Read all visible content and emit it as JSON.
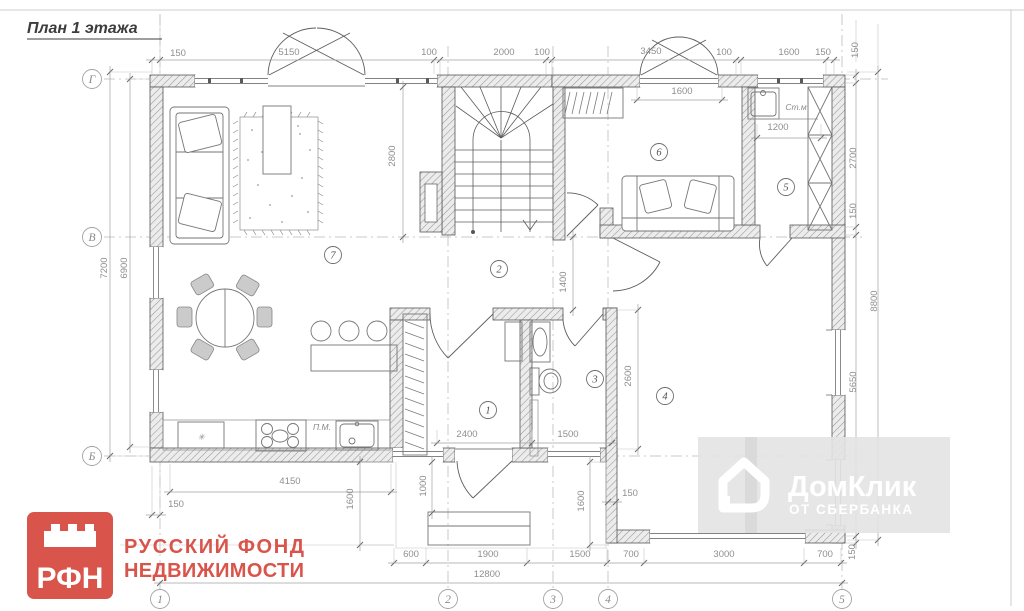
{
  "title": "План 1 этажа",
  "colors": {
    "accent_red": "#d9544b",
    "watermark_gray": "#e3e3e3",
    "drawing_line": "#565656",
    "dimension_gray": "#8f8f8f"
  },
  "plan": {
    "dimensions": [
      {
        "t": "150",
        "x": 178,
        "y": 56,
        "r": 0
      },
      {
        "t": "5150",
        "x": 289,
        "y": 55,
        "r": 0
      },
      {
        "t": "100",
        "x": 429,
        "y": 55,
        "r": 0
      },
      {
        "t": "2000",
        "x": 504,
        "y": 55,
        "r": 0
      },
      {
        "t": "100",
        "x": 542,
        "y": 55,
        "r": 0
      },
      {
        "t": "3450",
        "x": 651,
        "y": 54,
        "r": 0
      },
      {
        "t": "100",
        "x": 724,
        "y": 55,
        "r": 0
      },
      {
        "t": "1600",
        "x": 789,
        "y": 55,
        "r": 0
      },
      {
        "t": "150",
        "x": 823,
        "y": 55,
        "r": 0
      },
      {
        "t": "150",
        "x": 858,
        "y": 50,
        "r": -90
      },
      {
        "t": "2700",
        "x": 856,
        "y": 158,
        "r": -90
      },
      {
        "t": "150",
        "x": 856,
        "y": 211,
        "r": -90
      },
      {
        "t": "5650",
        "x": 856,
        "y": 382,
        "r": -90
      },
      {
        "t": "8800",
        "x": 877,
        "y": 301,
        "r": -90
      },
      {
        "t": "7200",
        "x": 107,
        "y": 268,
        "r": -90
      },
      {
        "t": "6900",
        "x": 127,
        "y": 268,
        "r": -90
      },
      {
        "t": "2800",
        "x": 395,
        "y": 156,
        "r": -90
      },
      {
        "t": "1400",
        "x": 566,
        "y": 282,
        "r": -90
      },
      {
        "t": "1600",
        "x": 682,
        "y": 94,
        "r": 0
      },
      {
        "t": "1200",
        "x": 778,
        "y": 130,
        "r": 0
      },
      {
        "t": "2400",
        "x": 467,
        "y": 437,
        "r": 0
      },
      {
        "t": "1500",
        "x": 568,
        "y": 437,
        "r": 0
      },
      {
        "t": "2600",
        "x": 631,
        "y": 376,
        "r": -90
      },
      {
        "t": "150",
        "x": 176,
        "y": 507,
        "r": 0
      },
      {
        "t": "4150",
        "x": 290,
        "y": 484,
        "r": 0
      },
      {
        "t": "1600",
        "x": 353,
        "y": 499,
        "r": -90
      },
      {
        "t": "1000",
        "x": 426,
        "y": 486,
        "r": -90
      },
      {
        "t": "1600",
        "x": 584,
        "y": 501,
        "r": -90
      },
      {
        "t": "150",
        "x": 630,
        "y": 496,
        "r": 0
      },
      {
        "t": "600",
        "x": 411,
        "y": 557,
        "r": 0
      },
      {
        "t": "1900",
        "x": 488,
        "y": 557,
        "r": 0
      },
      {
        "t": "1500",
        "x": 580,
        "y": 557,
        "r": 0
      },
      {
        "t": "700",
        "x": 631,
        "y": 557,
        "r": 0
      },
      {
        "t": "3000",
        "x": 724,
        "y": 557,
        "r": 0
      },
      {
        "t": "700",
        "x": 825,
        "y": 557,
        "r": 0
      },
      {
        "t": "12800",
        "x": 487,
        "y": 577,
        "r": 0
      },
      {
        "t": "150",
        "x": 855,
        "y": 552,
        "r": -90
      }
    ],
    "grid_rows": [
      {
        "t": "Г",
        "x": 92,
        "y": 79
      },
      {
        "t": "В",
        "x": 92,
        "y": 237
      },
      {
        "t": "Б",
        "x": 92,
        "y": 456
      }
    ],
    "grid_cols": [
      {
        "t": "1",
        "x": 160,
        "y": 599
      },
      {
        "t": "2",
        "x": 448,
        "y": 599
      },
      {
        "t": "3",
        "x": 553,
        "y": 599
      },
      {
        "t": "4",
        "x": 608,
        "y": 599
      },
      {
        "t": "5",
        "x": 842,
        "y": 599
      }
    ],
    "rooms": [
      {
        "t": "1",
        "x": 488,
        "y": 410
      },
      {
        "t": "2",
        "x": 499,
        "y": 269
      },
      {
        "t": "3",
        "x": 595,
        "y": 379
      },
      {
        "t": "4",
        "x": 665,
        "y": 396
      },
      {
        "t": "5",
        "x": 786,
        "y": 187
      },
      {
        "t": "6",
        "x": 659,
        "y": 152
      },
      {
        "t": "7",
        "x": 333,
        "y": 255
      }
    ],
    "fixture_labels": [
      {
        "t": "Ст.м",
        "x": 796,
        "y": 110
      },
      {
        "t": "П.М.",
        "x": 322,
        "y": 430
      },
      {
        "t": "✳",
        "x": 201,
        "y": 440
      }
    ]
  },
  "logo": {
    "abbr": "РФН",
    "line1": "РУССКИЙ  ФОНД",
    "line2": "НЕДВИЖИМОСТИ"
  },
  "watermark": {
    "name": "ДомКлик",
    "sub": "ОТ СБЕРБАНКА"
  }
}
